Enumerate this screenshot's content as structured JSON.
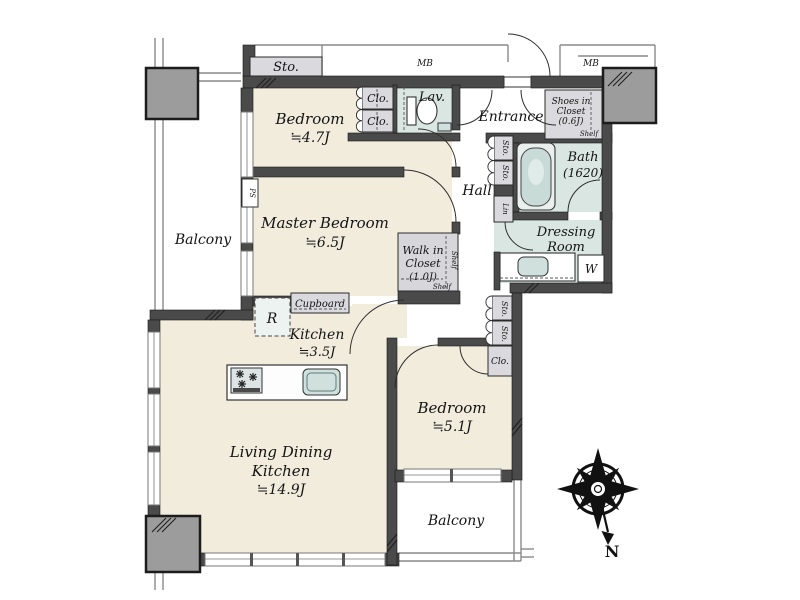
{
  "rooms": {
    "bedroom_top": {
      "name": "Bedroom",
      "area": "≒4.7J"
    },
    "master_bedroom": {
      "name": "Master Bedroom",
      "area": "≒6.5J"
    },
    "kitchen": {
      "name": "Kitchen",
      "area": "≒3.5J"
    },
    "living_dining": {
      "name_line1": "Living Dining",
      "name_line2": "Kitchen",
      "area": "≒14.9J"
    },
    "bedroom_right": {
      "name": "Bedroom",
      "area": "≒5.1J"
    },
    "bath": {
      "name": "Bath",
      "size": "(1620)"
    },
    "dressing_room": {
      "name_line1": "Dressing",
      "name_line2": "Room"
    },
    "lavatory": {
      "name": "Lav."
    },
    "entrance": {
      "name": "Entrance"
    },
    "hall": {
      "name": "Hall"
    },
    "walk_in_closet": {
      "name_line1": "Walk in",
      "name_line2": "Closet",
      "area": "(1.0J)",
      "shelf_side": "Shelf",
      "shelf_bottom": "Shelf"
    },
    "shoes_in_closet": {
      "name_line1": "Shoes in",
      "name_line2": "Closet",
      "area": "(0.6J)",
      "shelf": "Shelf"
    },
    "balcony_left": {
      "name": "Balcony"
    },
    "balcony_bottom": {
      "name": "Balcony"
    }
  },
  "storage": {
    "sto_corridor": "Sto.",
    "clo_upper_1": "Clo.",
    "clo_upper_2": "Clo.",
    "sto_hall_upper_1": "Sto.",
    "sto_hall_upper_2": "Sto.",
    "linen": "Lin",
    "sto_hall_lower_1": "Sto.",
    "sto_hall_lower_2": "Sto.",
    "clo_bedroom_right": "Clo.",
    "cupboard": "Cupboard"
  },
  "utilities": {
    "meter_box_left": "MB",
    "meter_box_right": "MB",
    "pipe_space": "PS",
    "refrigerator": "R",
    "washing_machine": "W"
  },
  "compass": {
    "label": "N"
  },
  "colors": {
    "room_floor": "#f1ecdc",
    "wet_area_floor": "#d9e6e2",
    "closet_fill": "#dadade",
    "wall": "#4a4a4a",
    "pillar": "#9c9c9c"
  }
}
